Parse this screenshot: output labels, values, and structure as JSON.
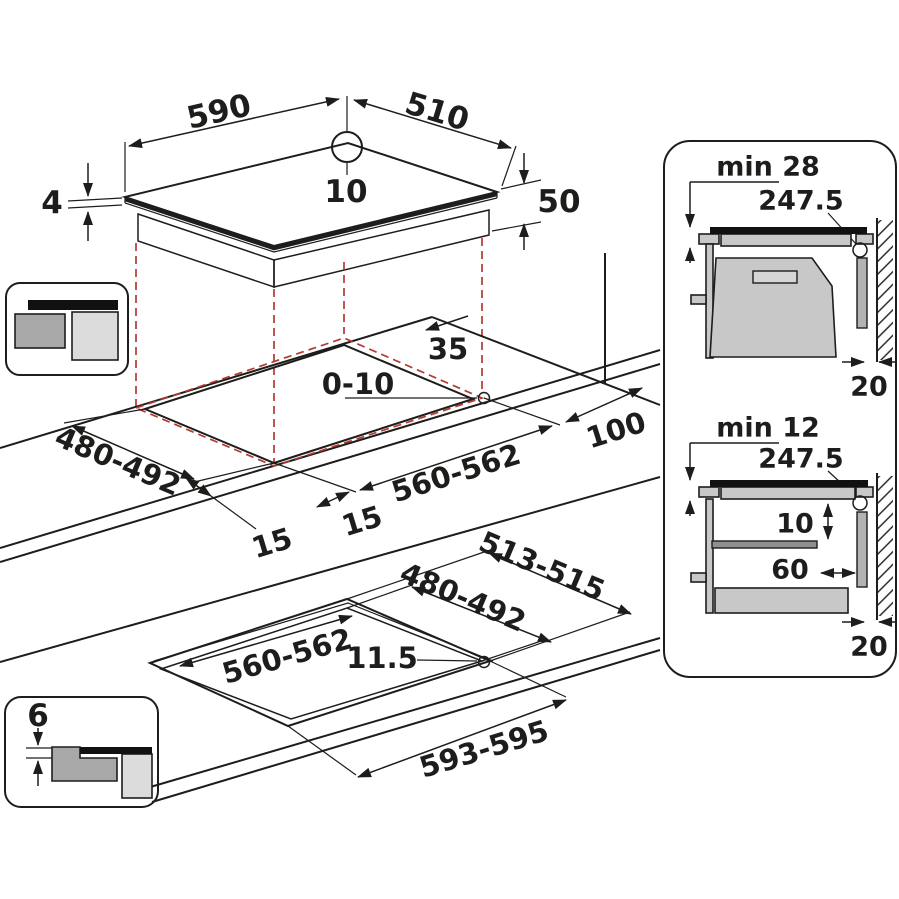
{
  "hob": {
    "width": "590",
    "depth": "510",
    "center_mark": "10",
    "glass_thickness": "4",
    "body_height": "50"
  },
  "cutout_top": {
    "back_clearance": "35",
    "edge_gap": "0-10",
    "depth": "480-492",
    "width": "560-562",
    "front_margin_left": "15",
    "front_margin_right": "15",
    "right_clearance": "100"
  },
  "cutout_flush": {
    "width": "560-562",
    "corner_radius": "11.5",
    "depth": "480-492",
    "recess_depth": "513-515",
    "recess_width": "593-595",
    "recess_step": "6"
  },
  "side_view_top": {
    "min_clearance": "min 28",
    "center_distance": "247.5",
    "rear_gap": "20"
  },
  "side_view_bottom": {
    "min_clearance": "min 12",
    "center_distance": "247.5",
    "shelf_clearance": "10",
    "shelf_setback": "60",
    "rear_gap": "20"
  },
  "colors": {
    "line": "#1d1d1b",
    "projection_red": "#b23a32",
    "gray_mid": "#c8c8c8",
    "gray_dark": "#8f8f8f",
    "gray_light": "#dcdcdc"
  }
}
